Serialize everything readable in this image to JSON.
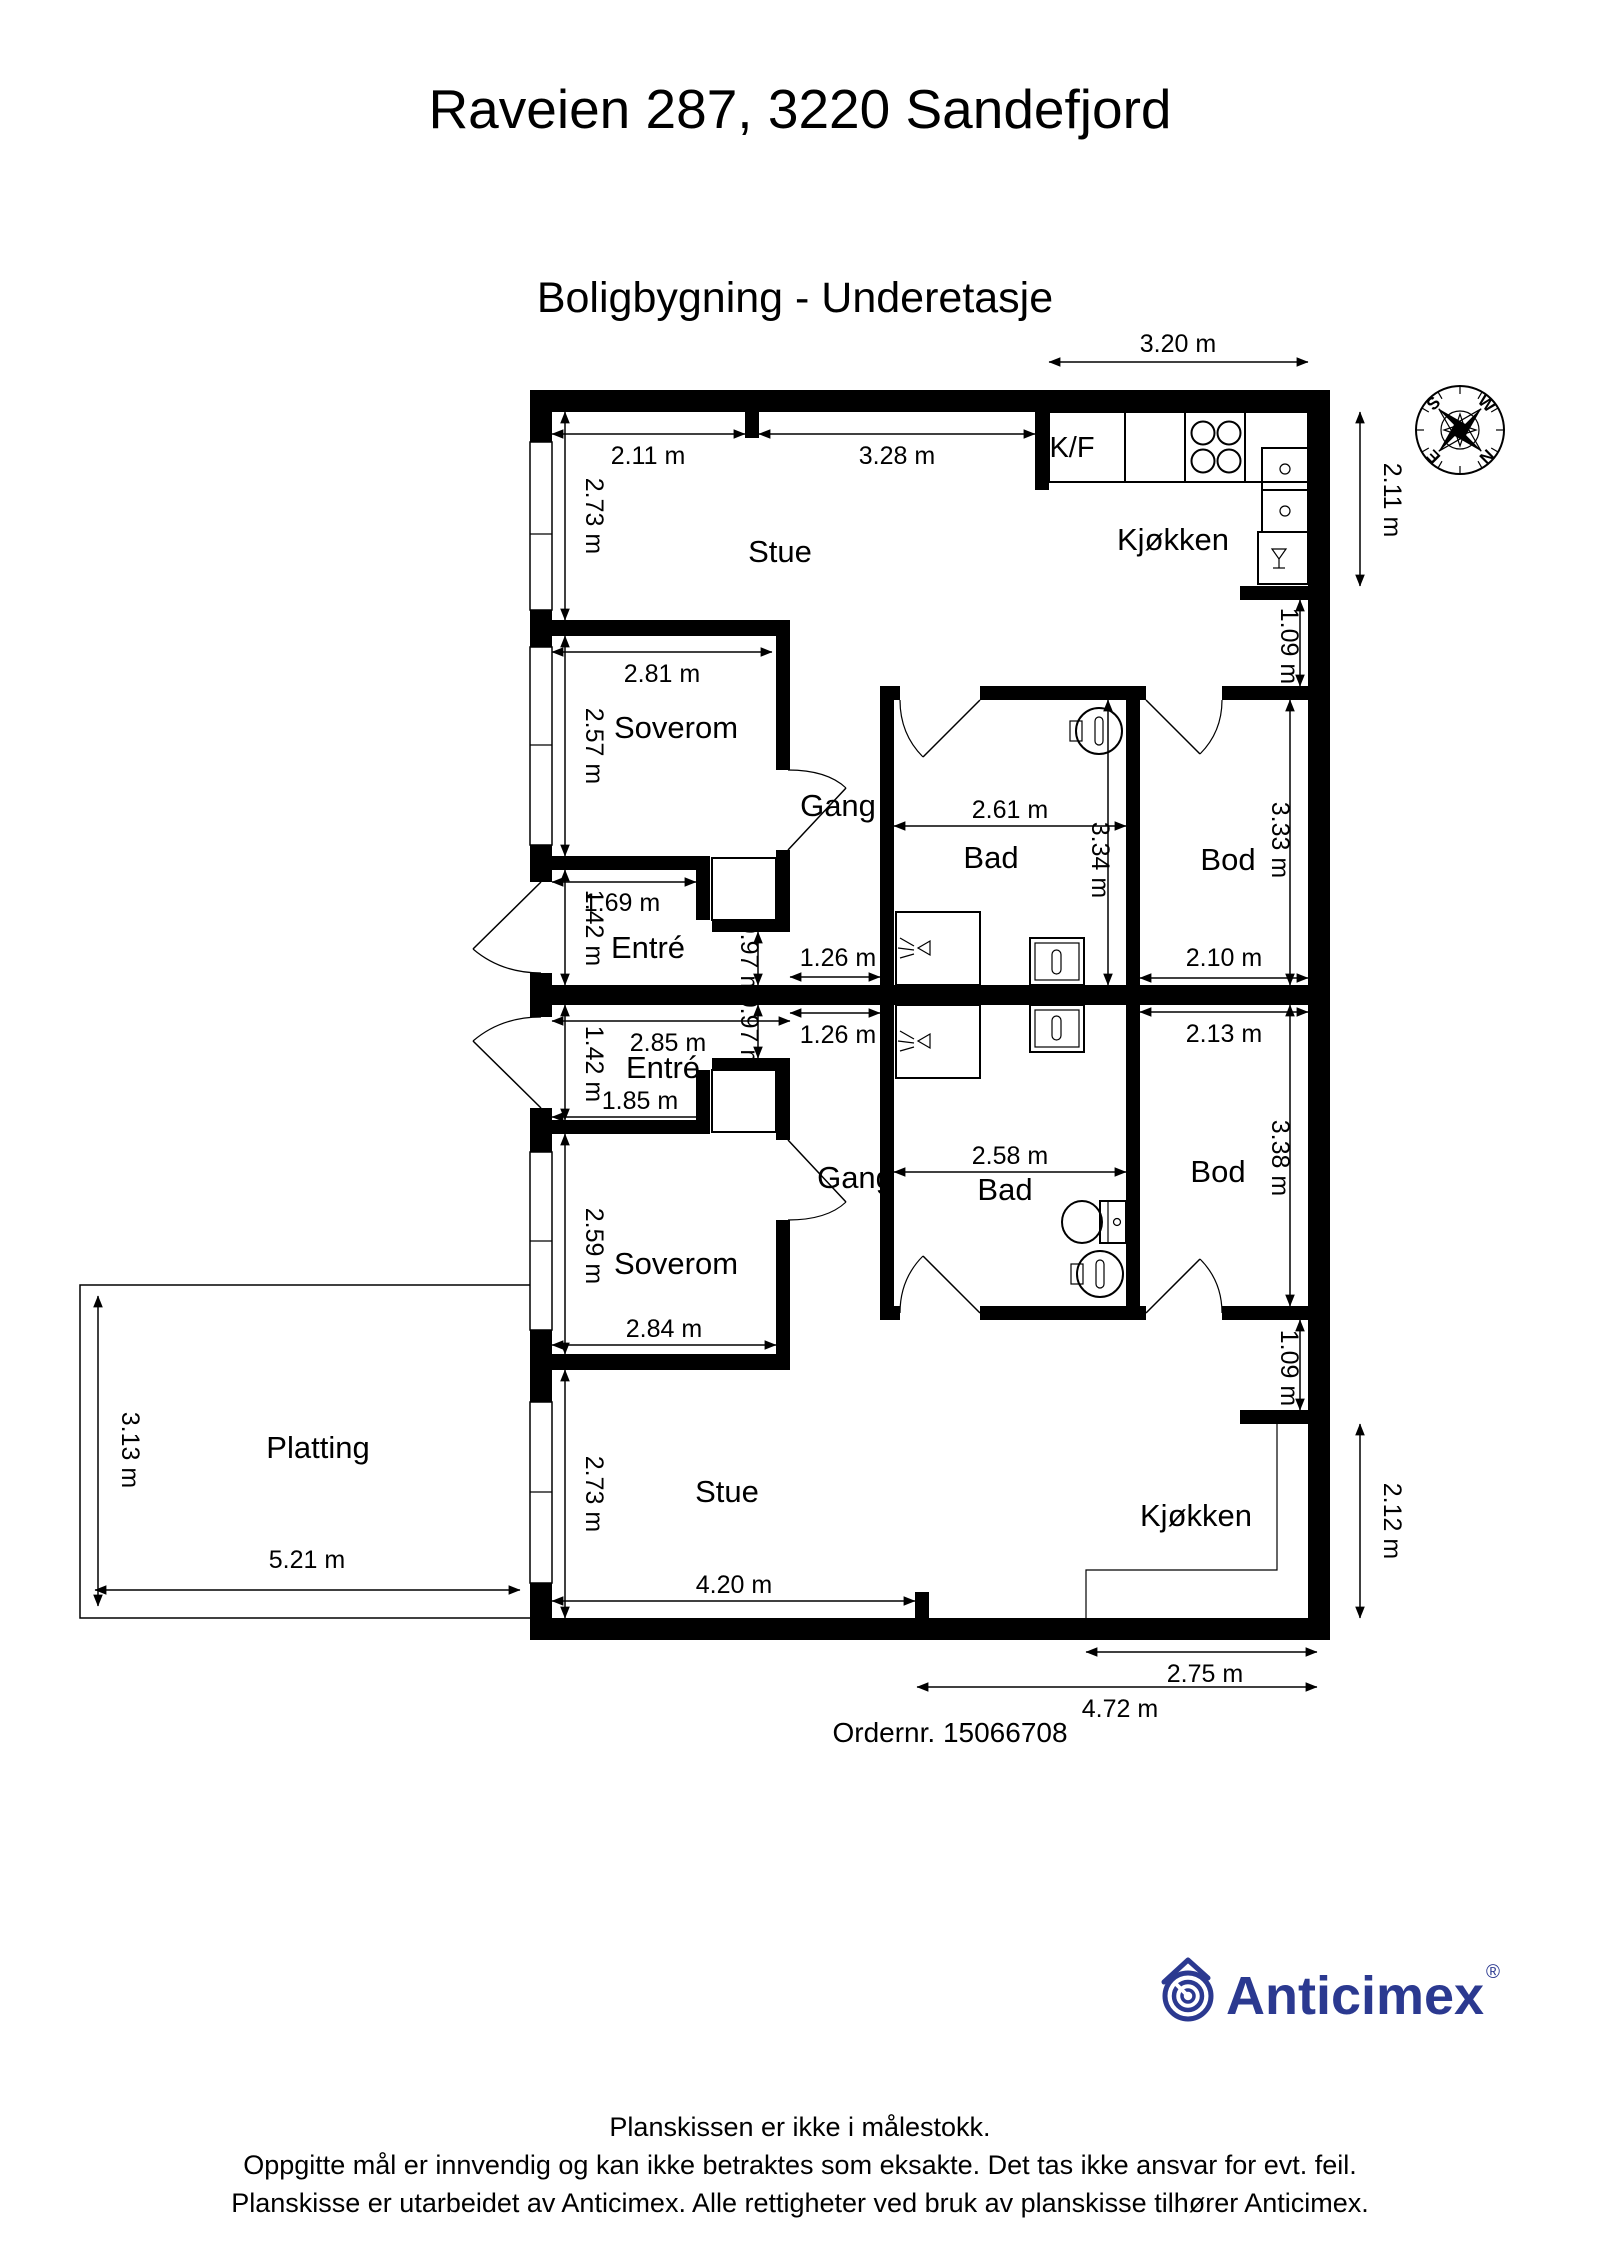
{
  "header": {
    "title": "Raveien 287, 3220 Sandefjord",
    "subtitle": "Boligbygning - Underetasje"
  },
  "order_number": "Ordernr. 15066708",
  "compass": {
    "north": "N",
    "south": "S",
    "east": "E",
    "west": "W"
  },
  "logo": {
    "text": "Anticimex",
    "registered_mark": "®",
    "color": "#2b3990"
  },
  "footer": {
    "line1": "Planskissen er ikke i målestokk.",
    "line2": "Oppgitte mål er innvendig og kan ikke betraktes som eksakte. Det tas ikke ansvar for evt. feil.",
    "line3": "Planskisse er utarbeidet av Anticimex. Alle rettigheter ved bruk av planskisse tilhører Anticimex."
  },
  "rooms": {
    "stue_upper": "Stue",
    "kjokken_upper": "Kjøkken",
    "kf": "K/F",
    "soverom_upper": "Soverom",
    "gang_upper": "Gang",
    "entre_upper": "Entré",
    "bad_upper": "Bad",
    "bod_upper": "Bod",
    "entre_lower": "Entré",
    "gang_lower": "Gang",
    "soverom_lower": "Soverom",
    "bad_lower": "Bad",
    "bod_lower": "Bod",
    "stue_lower": "Stue",
    "kjokken_lower": "Kjøkken",
    "platting": "Platting"
  },
  "dimensions": {
    "kitchen_top": "3.20 m",
    "stue_top_left": "2.11 m",
    "stue_top_right": "3.28 m",
    "stue_left": "2.73 m",
    "soverom_top": "2.81 m",
    "soverom_left": "2.57 m",
    "entre_width": "1.69 m",
    "entre_height": "1.42 m",
    "gang_passage": "0.97 m",
    "gang_width": "1.26 m",
    "bad_width": "2.61 m",
    "bad_height": "3.34 m",
    "bod_width": "2.10 m",
    "bod_height": "3.33 m",
    "right_gap": "1.09 m",
    "kitchen_right": "2.11 m",
    "entre2_width": "2.85 m",
    "entre2_height": "1.42 m",
    "entre2_inner": "1.85 m",
    "gang2_passage": "0.97 m",
    "gang2_width": "1.26 m",
    "bad2_width": "2.58 m",
    "bod2_width": "2.13 m",
    "bod2_height": "3.38 m",
    "right2_gap": "1.09 m",
    "soverom2_left": "2.59 m",
    "soverom2_bottom": "2.84 m",
    "stue2_left": "2.73 m",
    "stue2_bottom": "4.20 m",
    "kitchen2_right": "2.12 m",
    "kitchen2_bottom": "2.75 m",
    "bottom_total": "4.72 m",
    "platting_height": "3.13 m",
    "platting_width": "5.21 m"
  }
}
